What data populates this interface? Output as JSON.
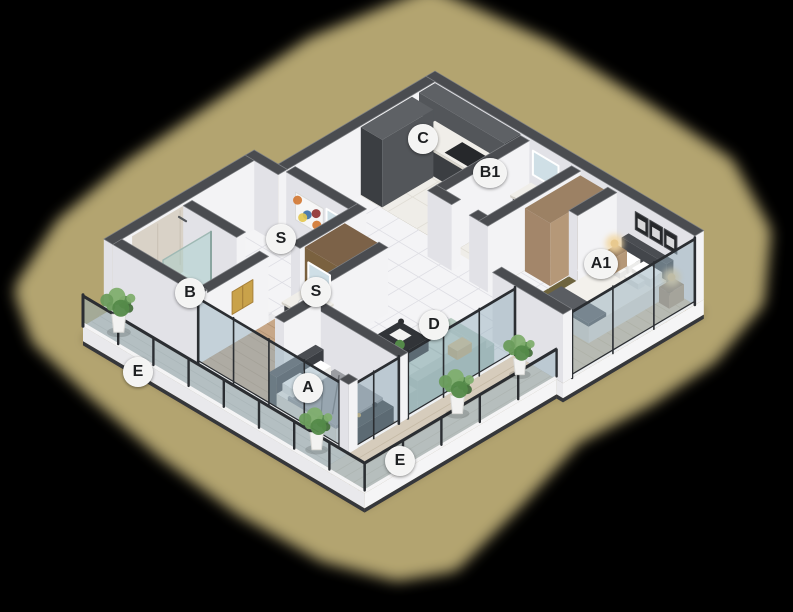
{
  "image": {
    "width": 793,
    "height": 612,
    "background": "#000000",
    "kind": "isometric-3d-apartment-floor-plan"
  },
  "glow": {
    "color": "#b3a470"
  },
  "badge": {
    "background": "#f4f4f3",
    "text_color": "#1d1f21"
  },
  "room_labels": [
    {
      "id": "c",
      "text": "C",
      "x": 423,
      "y": 139
    },
    {
      "id": "b1",
      "text": "B1",
      "x": 490,
      "y": 173
    },
    {
      "id": "a1",
      "text": "A1",
      "x": 601,
      "y": 264
    },
    {
      "id": "s1",
      "text": "S",
      "x": 281,
      "y": 239
    },
    {
      "id": "s2",
      "text": "S",
      "x": 316,
      "y": 292
    },
    {
      "id": "b",
      "text": "B",
      "x": 190,
      "y": 293
    },
    {
      "id": "e1",
      "text": "E",
      "x": 138,
      "y": 372
    },
    {
      "id": "a",
      "text": "A",
      "x": 308,
      "y": 388
    },
    {
      "id": "d",
      "text": "D",
      "x": 434,
      "y": 325
    },
    {
      "id": "e2",
      "text": "E",
      "x": 400,
      "y": 461
    }
  ],
  "palette": {
    "wall_top": "#4a4c50",
    "wall_top_edge": "#7e8084",
    "wall_se": "#f3f3f5",
    "wall_sw": "#e2e2e7",
    "wall_white": "#fafafb",
    "slab_side": "#f5f5f6",
    "slab_side_sw": "#e9e9ec",
    "slab_edge": "#35373b",
    "tile": "#f4f4f6",
    "grout": "#dedee4",
    "marble_floor": "#efede8",
    "marble_grout": "#e0ddd5",
    "wood_floor": "#d9c5a8",
    "wood_plank": "#c8b493",
    "wood_floor_mid": "#c7a788",
    "wood_plank_mid": "#b39374",
    "bath_floor": "#e9e9eb",
    "deck_sw": "#d2cfc7",
    "deck_sw_plank": "#c0bdb4",
    "deck_se": "#d6ccbc",
    "deck_se_plank": "#c5baa6",
    "cabinet_dark": "#53565a",
    "cabinet_dark_se": "#44474b",
    "cabinet_dark_sw": "#3b3e42",
    "cabinet_top": "#5e6165",
    "counter_white": "#f0eee9",
    "furn_darker_top": "#313438",
    "furn_darker_se": "#232528",
    "furn_darker_sw": "#2a2c30",
    "wood_furn_top": "#9c8164",
    "wood_furn_se": "#b59878",
    "wood_furn_sw": "#a3866a",
    "sofa": "#cbdcd3",
    "sofa_shade": "#b8ccc2",
    "sofa_dark": "#a9bfb4",
    "sofa_pillow": "#d9c08a",
    "bed_white_top": "#f3f1ec",
    "bed_white_se": "#e2dfd8",
    "bed_white_sw": "#d6d3cb",
    "bed_gray_top": "#9b9da2",
    "bed_gray_se": "#85878c",
    "bed_gray_sw": "#8e9095",
    "bed_gray_pattern": "#64666b",
    "headboard_top": "#4a4d52",
    "headboard_se": "#3a3d42",
    "headboard_sw": "#43464b",
    "throw_top": "#5a5d62",
    "throw_se": "#4c4f54",
    "throw_sw": "#515459",
    "tv_top": "#2a2c30",
    "tv_se": "#17181b",
    "tv_sw": "#1f2124",
    "glass": "rgba(150,176,190,0.5)",
    "glass_teal": "rgba(160,205,200,0.45)",
    "frame": "#2b2e32",
    "mirror": "#cfdfe6",
    "mirror_edge": "#ffffff",
    "towel_gold": "#c9a24a",
    "towel_fold": "#a8813a",
    "plant_g1": "#6a9c5c",
    "plant_g2": "#548a49",
    "plant_g3": "#7fae6e",
    "plant_g4": "#47703d",
    "pot": "#f2f2f1",
    "pot_edge": "#d9d9d6",
    "lamp_glow": "rgba(242,214,160,0.85)",
    "lamp_core": "#e8c98f",
    "art_frame": "#f6f6f6",
    "art_c1": "#d2762f",
    "art_c2": "#3c6fa5",
    "art_c3": "#8f2f2f",
    "art_c4": "#e3c74f",
    "shadow": "rgba(55,48,22,0.55)"
  }
}
